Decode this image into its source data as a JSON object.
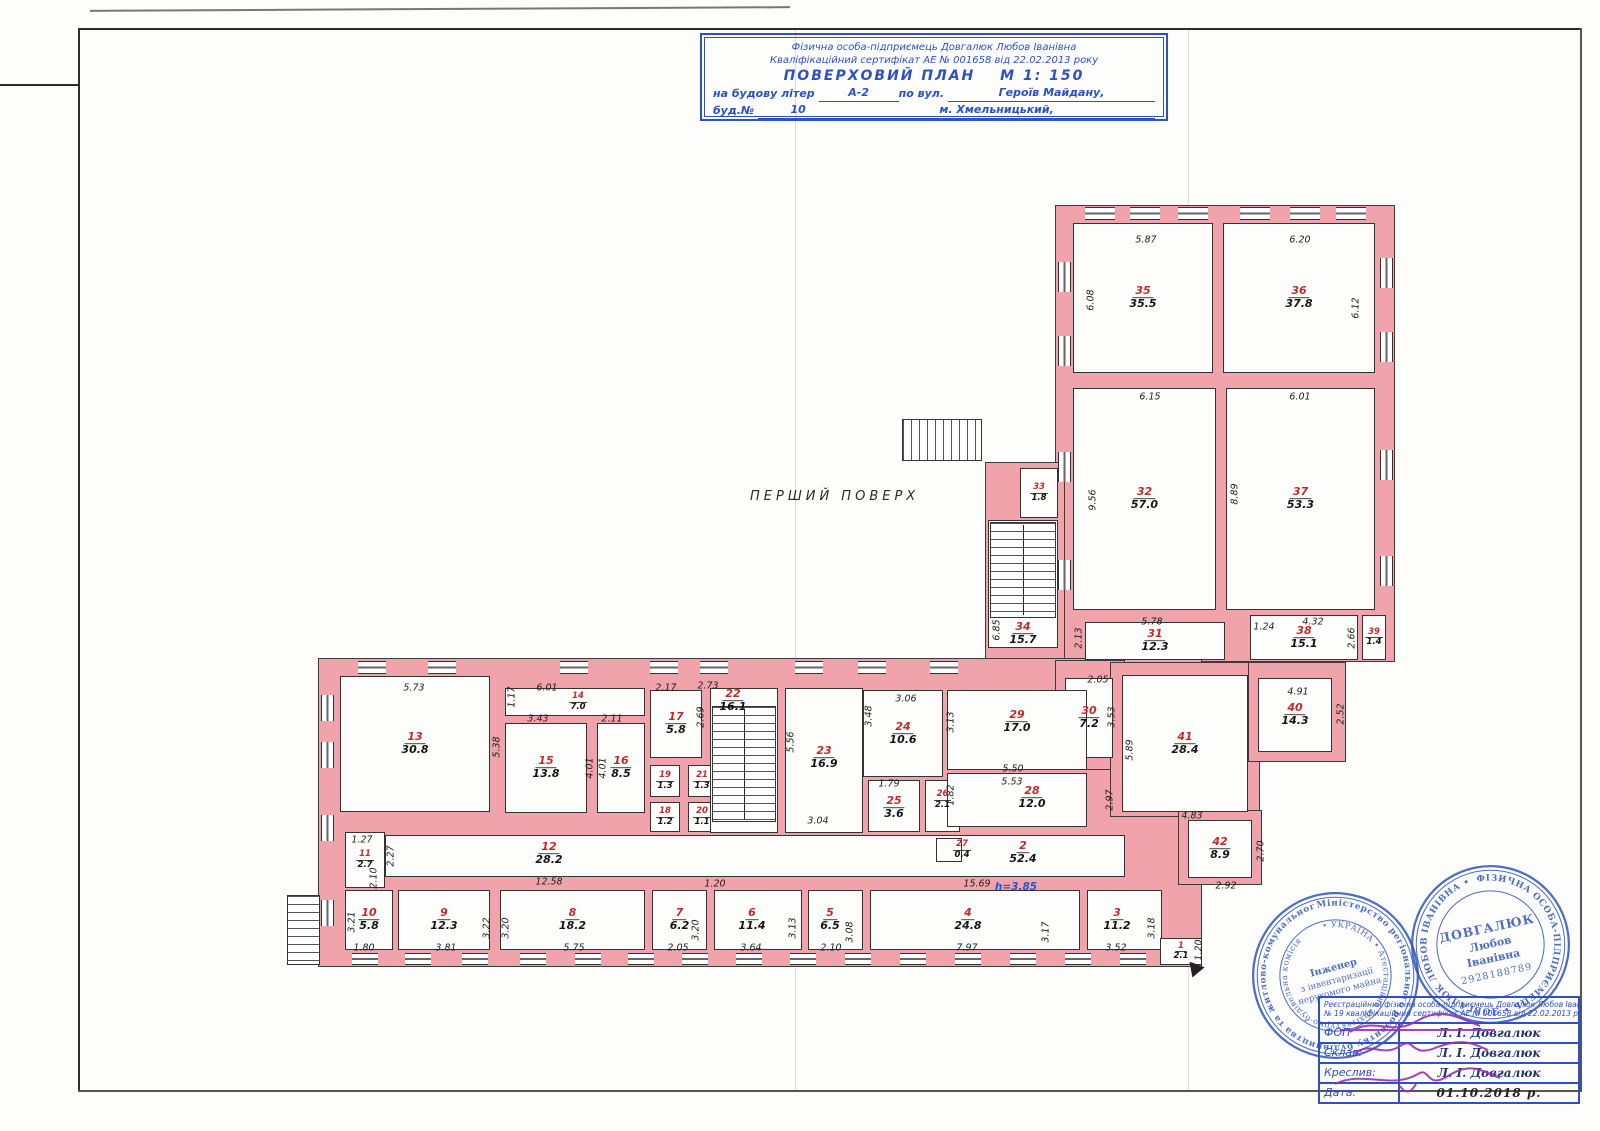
{
  "title_block": {
    "line1": "Фізична особа-підприємець Довгалюк Любов Іванівна",
    "line2": "Кваліфікаційний сертифікат АЕ № 001658 від 22.02.2013 року",
    "plan_title": "ПОВЕРХОВИЙ ПЛАН",
    "scale": "М 1: 150",
    "na_budovu": "на будову літер",
    "liter": "А-2",
    "po_vul": "по вул.",
    "street": "Героїв Майдану,",
    "bud_no": "буд.№",
    "bud_num": "10",
    "city": "м. Хмельницький,"
  },
  "floor_label": "ПЕРШИЙ ПОВЕРХ",
  "plan": {
    "wall_color": "#f0a3ab",
    "room_number_color": "#c22a2a",
    "bodies": [
      [
        1055,
        205,
        340,
        457
      ],
      [
        985,
        462,
        80,
        200
      ],
      [
        318,
        658,
        884,
        309
      ],
      [
        1055,
        660,
        70,
        110
      ],
      [
        1110,
        662,
        150,
        155
      ],
      [
        1248,
        662,
        98,
        100
      ],
      [
        1178,
        810,
        84,
        75
      ]
    ],
    "rooms": [
      {
        "n": "12",
        "a": "28.2",
        "x": 385,
        "y": 835,
        "w": 740,
        "h": 42,
        "lx": 549,
        "ly": 854
      },
      {
        "n": "2",
        "a": "52.4",
        "lx": 1023,
        "ly": 853
      },
      {
        "n": "35",
        "a": "35.5",
        "x": 1073,
        "y": 223,
        "w": 140,
        "h": 150
      },
      {
        "n": "36",
        "a": "37.8",
        "x": 1223,
        "y": 223,
        "w": 152,
        "h": 150
      },
      {
        "n": "32",
        "a": "57.0",
        "x": 1073,
        "y": 388,
        "w": 143,
        "h": 222
      },
      {
        "n": "37",
        "a": "53.3",
        "x": 1226,
        "y": 388,
        "w": 149,
        "h": 222
      },
      {
        "n": "33",
        "a": "1.8",
        "x": 1020,
        "y": 468,
        "w": 38,
        "h": 50,
        "s": 1
      },
      {
        "n": "34",
        "a": "15.7",
        "x": 988,
        "y": 520,
        "w": 70,
        "h": 128,
        "ly": 634
      },
      {
        "n": "31",
        "a": "12.3",
        "x": 1085,
        "y": 622,
        "w": 140,
        "h": 38
      },
      {
        "n": "38",
        "a": "15.1",
        "x": 1250,
        "y": 615,
        "w": 108,
        "h": 45
      },
      {
        "n": "39",
        "a": "1.4",
        "x": 1362,
        "y": 615,
        "w": 24,
        "h": 45,
        "s": 1
      },
      {
        "n": "30",
        "a": "7.2",
        "x": 1065,
        "y": 678,
        "w": 48,
        "h": 80
      },
      {
        "n": "41",
        "a": "28.4",
        "x": 1122,
        "y": 675,
        "w": 126,
        "h": 137
      },
      {
        "n": "40",
        "a": "14.3",
        "x": 1258,
        "y": 678,
        "w": 74,
        "h": 74
      },
      {
        "n": "42",
        "a": "8.9",
        "x": 1188,
        "y": 820,
        "w": 64,
        "h": 58
      },
      {
        "n": "13",
        "a": "30.8",
        "x": 340,
        "y": 676,
        "w": 150,
        "h": 136
      },
      {
        "n": "14",
        "a": "7.0",
        "x": 505,
        "y": 688,
        "w": 140,
        "h": 28,
        "lx": 578,
        "ly": 702,
        "s": 1
      },
      {
        "n": "15",
        "a": "13.8",
        "x": 505,
        "y": 723,
        "w": 82,
        "h": 90
      },
      {
        "n": "16",
        "a": "8.5",
        "x": 597,
        "y": 723,
        "w": 48,
        "h": 90
      },
      {
        "n": "17",
        "a": "5.8",
        "x": 650,
        "y": 690,
        "w": 52,
        "h": 68
      },
      {
        "n": "19",
        "a": "1.3",
        "x": 650,
        "y": 765,
        "w": 30,
        "h": 32,
        "s": 1
      },
      {
        "n": "21",
        "a": "1.3",
        "x": 688,
        "y": 765,
        "w": 28,
        "h": 32,
        "s": 1
      },
      {
        "n": "18",
        "a": "1.2",
        "x": 650,
        "y": 802,
        "w": 30,
        "h": 30,
        "s": 1
      },
      {
        "n": "20",
        "a": "1.1",
        "x": 688,
        "y": 802,
        "w": 28,
        "h": 30,
        "s": 1
      },
      {
        "n": "22",
        "a": "16.1",
        "x": 710,
        "y": 688,
        "w": 68,
        "h": 145,
        "lx": 733,
        "ly": 701
      },
      {
        "n": "23",
        "a": "16.9",
        "x": 785,
        "y": 688,
        "w": 78,
        "h": 145,
        "ly": 758
      },
      {
        "n": "24",
        "a": "10.6",
        "x": 863,
        "y": 690,
        "w": 80,
        "h": 87
      },
      {
        "n": "25",
        "a": "3.6",
        "x": 868,
        "y": 780,
        "w": 52,
        "h": 52,
        "ly": 808
      },
      {
        "n": "26",
        "a": "2.1",
        "x": 925,
        "y": 780,
        "w": 35,
        "h": 52,
        "ly": 800,
        "s": 1
      },
      {
        "n": "29",
        "a": "17.0",
        "x": 947,
        "y": 690,
        "w": 140,
        "h": 80,
        "ly": 722
      },
      {
        "n": "28",
        "a": "12.0",
        "x": 947,
        "y": 773,
        "w": 140,
        "h": 54,
        "lx": 1032,
        "ly": 798
      },
      {
        "n": "27",
        "a": "0.4",
        "x": 936,
        "y": 838,
        "w": 26,
        "h": 24,
        "lx": 962,
        "ly": 850,
        "s": 1
      },
      {
        "n": "11",
        "a": "2.7",
        "x": 345,
        "y": 832,
        "w": 40,
        "h": 56,
        "s": 1
      },
      {
        "n": "10",
        "a": "5.8",
        "x": 345,
        "y": 890,
        "w": 48,
        "h": 60
      },
      {
        "n": "9",
        "a": "12.3",
        "x": 398,
        "y": 890,
        "w": 92,
        "h": 60
      },
      {
        "n": "8",
        "a": "18.2",
        "x": 500,
        "y": 890,
        "w": 145,
        "h": 60
      },
      {
        "n": "7",
        "a": "6.2",
        "x": 652,
        "y": 890,
        "w": 55,
        "h": 60
      },
      {
        "n": "6",
        "a": "11.4",
        "x": 714,
        "y": 890,
        "w": 88,
        "h": 60,
        "lx": 752
      },
      {
        "n": "5",
        "a": "6.5",
        "x": 808,
        "y": 890,
        "w": 55,
        "h": 60,
        "lx": 830
      },
      {
        "n": "4",
        "a": "24.8",
        "x": 870,
        "y": 890,
        "w": 210,
        "h": 60,
        "lx": 968
      },
      {
        "n": "3",
        "a": "11.2",
        "x": 1087,
        "y": 890,
        "w": 75,
        "h": 60,
        "lx": 1117
      },
      {
        "n": "1",
        "a": "2.1",
        "x": 1160,
        "y": 938,
        "w": 42,
        "h": 27,
        "s": 1
      }
    ],
    "dims": [
      {
        "t": "5.87",
        "x": 1146,
        "y": 240
      },
      {
        "t": "6.20",
        "x": 1300,
        "y": 240
      },
      {
        "t": "6.08",
        "x": 1091,
        "y": 300,
        "v": 1
      },
      {
        "t": "6.12",
        "x": 1356,
        "y": 308,
        "v": 1
      },
      {
        "t": "6.15",
        "x": 1150,
        "y": 397
      },
      {
        "t": "6.01",
        "x": 1300,
        "y": 397
      },
      {
        "t": "9.56",
        "x": 1093,
        "y": 500,
        "v": 1
      },
      {
        "t": "8.89",
        "x": 1235,
        "y": 494,
        "v": 1
      },
      {
        "t": "5.78",
        "x": 1152,
        "y": 622
      },
      {
        "t": "2.13",
        "x": 1079,
        "y": 638,
        "v": 1
      },
      {
        "t": "1.24",
        "x": 1264,
        "y": 627
      },
      {
        "t": "4.32",
        "x": 1313,
        "y": 622
      },
      {
        "t": "2.66",
        "x": 1352,
        "y": 638,
        "v": 1
      },
      {
        "t": "2.05",
        "x": 1098,
        "y": 680
      },
      {
        "t": "6.85",
        "x": 997,
        "y": 630,
        "v": 1
      },
      {
        "t": "3.53",
        "x": 1112,
        "y": 717,
        "v": 1
      },
      {
        "t": "5.89",
        "x": 1130,
        "y": 750,
        "v": 1
      },
      {
        "t": "4.91",
        "x": 1298,
        "y": 692
      },
      {
        "t": "2.52",
        "x": 1341,
        "y": 714,
        "v": 1
      },
      {
        "t": "4.83",
        "x": 1192,
        "y": 816
      },
      {
        "t": "2.97",
        "x": 1110,
        "y": 800,
        "v": 1
      },
      {
        "t": "2.70",
        "x": 1261,
        "y": 851,
        "v": 1
      },
      {
        "t": "2.92",
        "x": 1226,
        "y": 886
      },
      {
        "t": "5.73",
        "x": 414,
        "y": 688
      },
      {
        "t": "1.17",
        "x": 512,
        "y": 697,
        "v": 1
      },
      {
        "t": "6.01",
        "x": 547,
        "y": 688
      },
      {
        "t": "3.43",
        "x": 538,
        "y": 719
      },
      {
        "t": "2.11",
        "x": 612,
        "y": 719
      },
      {
        "t": "5.38",
        "x": 497,
        "y": 747,
        "v": 1
      },
      {
        "t": "4.01",
        "x": 590,
        "y": 768,
        "v": 1
      },
      {
        "t": "4.01",
        "x": 603,
        "y": 768,
        "v": 1
      },
      {
        "t": "2.17",
        "x": 666,
        "y": 688
      },
      {
        "t": "2.73",
        "x": 708,
        "y": 686
      },
      {
        "t": "2.69",
        "x": 701,
        "y": 717,
        "v": 1
      },
      {
        "t": "5.56",
        "x": 791,
        "y": 742,
        "v": 1
      },
      {
        "t": "3.04",
        "x": 818,
        "y": 821
      },
      {
        "t": "3.06",
        "x": 906,
        "y": 699
      },
      {
        "t": "3.48",
        "x": 869,
        "y": 716,
        "v": 1
      },
      {
        "t": "3.13",
        "x": 951,
        "y": 722,
        "v": 1
      },
      {
        "t": "1.79",
        "x": 889,
        "y": 784
      },
      {
        "t": "1.82",
        "x": 951,
        "y": 795,
        "v": 1
      },
      {
        "t": "5.50",
        "x": 1013,
        "y": 769
      },
      {
        "t": "5.53",
        "x": 1012,
        "y": 782
      },
      {
        "t": "1.27",
        "x": 362,
        "y": 840
      },
      {
        "t": "2.27",
        "x": 391,
        "y": 856,
        "v": 1
      },
      {
        "t": "2.10",
        "x": 374,
        "y": 878,
        "v": 1
      },
      {
        "t": "12.58",
        "x": 549,
        "y": 882
      },
      {
        "t": "1.20",
        "x": 715,
        "y": 884
      },
      {
        "t": "15.69",
        "x": 977,
        "y": 884
      },
      {
        "t": "3.21",
        "x": 352,
        "y": 922,
        "v": 1
      },
      {
        "t": "1.80",
        "x": 364,
        "y": 948
      },
      {
        "t": "3.81",
        "x": 446,
        "y": 948
      },
      {
        "t": "3.22",
        "x": 487,
        "y": 928,
        "v": 1
      },
      {
        "t": "3.20",
        "x": 506,
        "y": 928,
        "v": 1
      },
      {
        "t": "5.75",
        "x": 574,
        "y": 948
      },
      {
        "t": "2.05",
        "x": 678,
        "y": 948
      },
      {
        "t": "3.20",
        "x": 696,
        "y": 930,
        "v": 1
      },
      {
        "t": "3.64",
        "x": 751,
        "y": 948
      },
      {
        "t": "3.13",
        "x": 793,
        "y": 928,
        "v": 1
      },
      {
        "t": "2.10",
        "x": 831,
        "y": 948
      },
      {
        "t": "3.08",
        "x": 850,
        "y": 932,
        "v": 1
      },
      {
        "t": "7.97",
        "x": 967,
        "y": 948
      },
      {
        "t": "3.17",
        "x": 1046,
        "y": 932,
        "v": 1
      },
      {
        "t": "3.18",
        "x": 1152,
        "y": 928,
        "v": 1
      },
      {
        "t": "3.52",
        "x": 1116,
        "y": 948
      },
      {
        "t": "1.20",
        "x": 1199,
        "y": 950,
        "v": 1
      },
      {
        "t": "h=3.85",
        "x": 1016,
        "y": 887,
        "c": "hdim"
      }
    ],
    "stairs": [
      {
        "x": 902,
        "y": 419,
        "w": 80,
        "h": 42,
        "d": "h"
      },
      {
        "x": 990,
        "y": 522,
        "w": 66,
        "h": 96,
        "d": "v",
        "dv": 1
      },
      {
        "x": 712,
        "y": 706,
        "w": 64,
        "h": 116,
        "d": "v",
        "dv": 1
      },
      {
        "x": 287,
        "y": 895,
        "w": 33,
        "h": 70,
        "d": "v"
      }
    ],
    "windows": [
      [
        1085,
        207,
        30,
        13
      ],
      [
        1130,
        207,
        30,
        13
      ],
      [
        1178,
        207,
        30,
        13
      ],
      [
        1240,
        207,
        30,
        13
      ],
      [
        1290,
        207,
        30,
        13
      ],
      [
        1336,
        207,
        30,
        13
      ],
      [
        1058,
        262,
        13,
        30
      ],
      [
        1058,
        336,
        13,
        30
      ],
      [
        1058,
        452,
        13,
        30
      ],
      [
        1058,
        560,
        13,
        30
      ],
      [
        1380,
        258,
        13,
        30
      ],
      [
        1380,
        332,
        13,
        30
      ],
      [
        1380,
        450,
        13,
        30
      ],
      [
        1380,
        556,
        13,
        30
      ],
      [
        358,
        661,
        28,
        13
      ],
      [
        428,
        661,
        28,
        13
      ],
      [
        560,
        661,
        28,
        13
      ],
      [
        650,
        661,
        28,
        13
      ],
      [
        700,
        661,
        28,
        13
      ],
      [
        795,
        661,
        28,
        13
      ],
      [
        858,
        661,
        28,
        13
      ],
      [
        930,
        661,
        28,
        13
      ],
      [
        352,
        953,
        26,
        12
      ],
      [
        405,
        953,
        26,
        12
      ],
      [
        462,
        953,
        26,
        12
      ],
      [
        520,
        953,
        26,
        12
      ],
      [
        575,
        953,
        26,
        12
      ],
      [
        628,
        953,
        26,
        12
      ],
      [
        682,
        953,
        26,
        12
      ],
      [
        736,
        953,
        26,
        12
      ],
      [
        790,
        953,
        26,
        12
      ],
      [
        845,
        953,
        26,
        12
      ],
      [
        900,
        953,
        26,
        12
      ],
      [
        955,
        953,
        26,
        12
      ],
      [
        1010,
        953,
        26,
        12
      ],
      [
        1065,
        953,
        26,
        12
      ],
      [
        1120,
        953,
        26,
        12
      ],
      [
        321,
        695,
        13,
        26
      ],
      [
        321,
        742,
        13,
        26
      ],
      [
        321,
        815,
        13,
        26
      ],
      [
        321,
        900,
        13,
        26
      ]
    ]
  },
  "stamps": {
    "s1": {
      "ring1": "Міністерство регіонального розвитку будівництва та житлово-комунального господарства України",
      "ring2": "• УКРАЇНА •  Атестаційна архітектурно-будівельна комісія",
      "c1": "Інженер",
      "c2": "з інвентаризації",
      "c3": "нерухомого майна"
    },
    "s2": {
      "ring1": "ФІЗИЧНА ОСОБА-ПІДПРИЄМЕЦЬ  •  ДОВГАЛЮК ЛЮБОВ ІВАНІВНА  •",
      "name1": "ДОВГАЛЮК",
      "name2": "Любов",
      "name3": "Іванівна",
      "code": "2928188789"
    }
  },
  "sig_table": {
    "header1": "Реєстраційний  фізична особа-підприємець Довгалюк Любов Іванівна",
    "header2": "№ 19  кваліфікаційний сертифікат АЕ № 001658 від 22.02.2013 року",
    "rows": [
      {
        "label": "ФОП",
        "value": "Л. І. Довгалюк"
      },
      {
        "label": "Склав:",
        "value": "Л. І. Довгалюк"
      },
      {
        "label": "Креслив:",
        "value": "Л. І. Довгалюк"
      },
      {
        "label": "Дата:",
        "value": "01.10.2018 р."
      }
    ]
  }
}
